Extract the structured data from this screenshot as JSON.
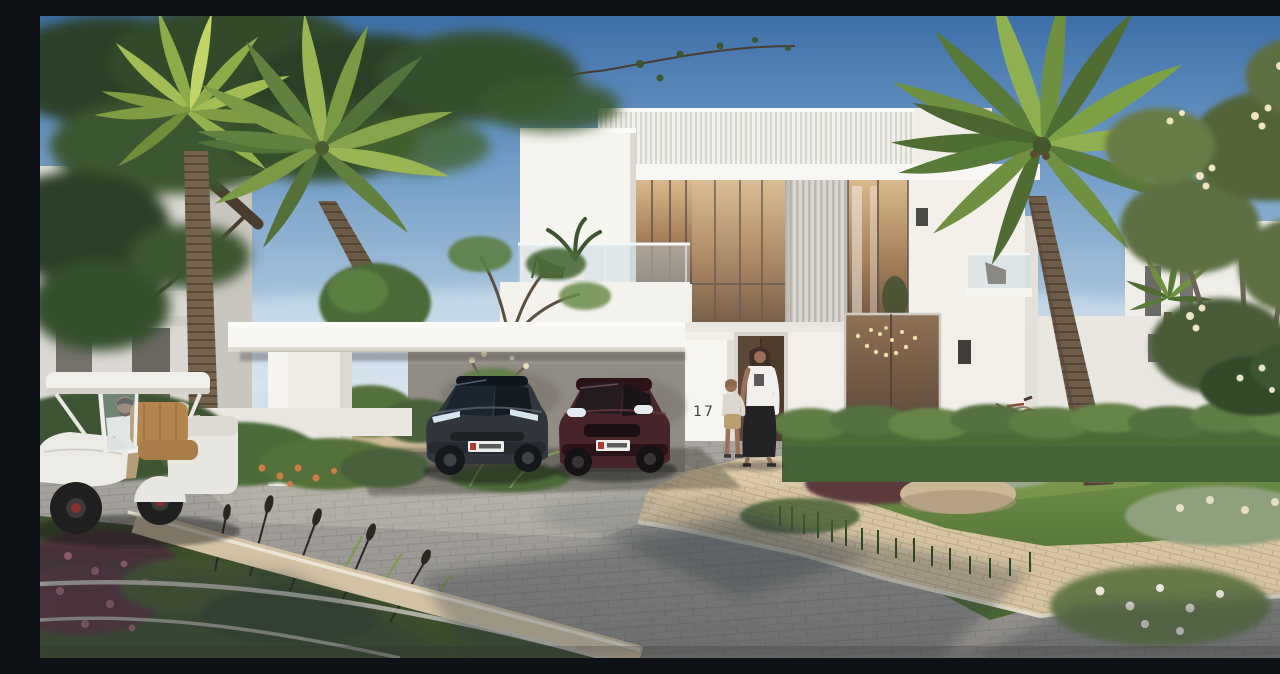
{
  "scene": {
    "description": "Photorealistic daytime rendering of a modern white two-storey villa with attached carport, palm trees, landscaped gardens, a curved paver driveway, two parked cars, a golf buggy and residents",
    "house_number": "17",
    "sky": {
      "top_color": "#3f6fa9",
      "mid_color": "#6e9ac5",
      "horizon_color": "#cfdfeb"
    },
    "buildings": {
      "main_villa": {
        "label": "modern two-storey white villa",
        "features": [
          "ribbed white roof fascia",
          "vertical louver privacy screen",
          "floor-to-ceiling warm-lit windows",
          "glass balcony with lounge chair and potted plant",
          "second glass balcony with chair",
          "tall dark timber entrance door",
          "house number 17 on carport pillar",
          "string-light chandelier in ground-floor window",
          "black wall sconces"
        ]
      },
      "left_villa": {
        "label": "neighbouring villa at left",
        "features": [
          "grey-white facade",
          "balcony railing",
          "dark windows"
        ]
      },
      "right_villa": {
        "label": "neighbouring villa at right",
        "features": [
          "white facade behind flowering tree",
          "dark slit windows"
        ]
      }
    },
    "carport": {
      "label": "flat-roof carport",
      "features": [
        "white cantilevered canopy slab",
        "thick square white pillar",
        "shaded grey back wall",
        "garden visible through open side"
      ]
    },
    "vehicles": {
      "sedan": {
        "label": "dark grey electric sedan parked under carport",
        "color": "#343a40",
        "license_plate": "white UAE-style plate"
      },
      "suv": {
        "label": "dark maroon SUV parked under carport",
        "color": "#46242a",
        "license_plate": "white UAE-style plate"
      },
      "golf_cart": {
        "label": "white golf buggy on road",
        "color": "#edebe6",
        "details": [
          "tan leather seats",
          "clear windshield",
          "dark wheels with red hub accent"
        ]
      }
    },
    "people": {
      "driver": {
        "label": "bearded man driving golf buggy",
        "clothing": "white polo shirt, khaki trousers"
      },
      "passenger": {
        "label": "grey-haired person beside golf buggy",
        "clothing": "pink striped jacket"
      },
      "woman": {
        "label": "woman walking toward entrance",
        "clothing": "white t-shirt, long black skirt"
      },
      "child": {
        "label": "toddler holding woman's hand",
        "clothing": "light top, tan shorts"
      }
    },
    "vegetation": {
      "pine_tree": "large dark leaning pine over top-left corner",
      "fan_palm": "bright fan palm at left with tall ringed trunk",
      "coconut_palm": "arching coconut palm left of villa",
      "right_palm": "large coconut palm in front of villa right wing",
      "small_palm": "small distant palm by right villa",
      "frangipani": "frangipani tree with cream flower clusters at right edge",
      "hedges": "clipped green hedge rows in front of villa",
      "flower_bushes": [
        "sage bushes with white blooms",
        "pink flowering shrubs",
        "maroon flower bed at bottom-left",
        "orange flowers at carport pillar"
      ]
    },
    "ground": {
      "road": "curved grey block-paver road with tree shadows",
      "driveway_apron": "sunlit beige paver apron at entrance",
      "sidewalk": "beige paver walkway crossing lower right",
      "curb": "beige curb band with white edge stones around flower-bed island"
    },
    "objects": {
      "bicycle": "red-brown bicycle leaning at hedge near villa wall",
      "rock": "beige landscape boulder in right garden",
      "chandelier": "string-light pendant cluster inside ground-floor window"
    }
  },
  "palette": {
    "villa_white": "#f6f4ef",
    "villa_shade": "#ddd9d2",
    "ribbed_fascia": "#d8d5ce",
    "louver": "#bdb8b0",
    "warm_glass_light": "#d9b98c",
    "warm_glass_dark": "#6e523a",
    "hedge_green": "#4c6a38",
    "grass_green": "#6a8a42",
    "palm_green": "#7a9a46",
    "pine_green": "#2c4126",
    "road_grey": "#a8a5a0",
    "paver_beige": "#d7c4a3",
    "shadow_blue": "rgba(45,52,66,0.32)"
  }
}
